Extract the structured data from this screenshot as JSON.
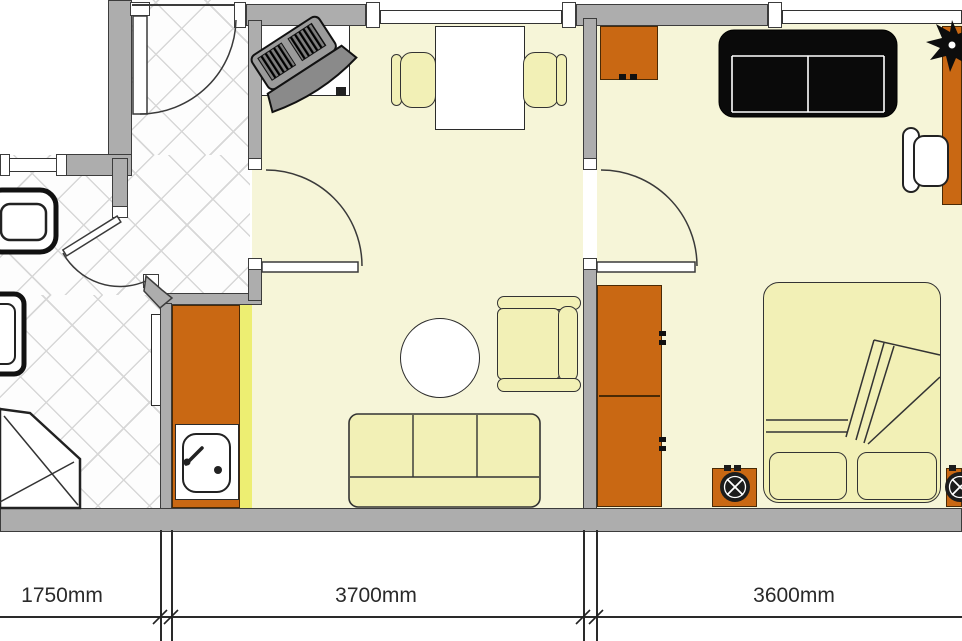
{
  "plan": {
    "type": "apartment-floor-plan",
    "rooms": [
      {
        "id": "hallway-bathroom",
        "floor": "ceramic-tile",
        "symbols": [
          "entrance-door",
          "interior-door",
          "toilet",
          "washbasin",
          "corner-shower",
          "wall-shelf",
          "window"
        ]
      },
      {
        "id": "living-room-kitchenette",
        "floor": "light-parquet",
        "symbols": [
          "tv-on-stand",
          "dining-table",
          "dining-chair",
          "dining-chair",
          "round-table",
          "armchair",
          "sofa",
          "kitchen-counter",
          "kitchen-sink",
          "swing-door",
          "window"
        ]
      },
      {
        "id": "bedroom",
        "floor": "light-parquet",
        "symbols": [
          "cabinet",
          "black-sofa",
          "desk",
          "desk-chair",
          "plant",
          "wardrobe",
          "double-bed",
          "pillow",
          "pillow",
          "nightstand",
          "nightstand",
          "swing-door",
          "window"
        ]
      }
    ]
  },
  "dimensions": {
    "left": "1750mm",
    "middle": "3700mm",
    "right": "3600mm"
  },
  "colors": {
    "wall": "#adadad",
    "wall_outline": "#3c3c3c",
    "floor_yellow": "#f6f5d8",
    "furniture_yellow": "#f2f0b6",
    "counter_highlight": "#edee72",
    "furniture_orange": "#c96813",
    "sofa_black": "#0a0a0a",
    "tile_line": "#d7d7d7",
    "dimension_text": "#2a2a2a"
  }
}
